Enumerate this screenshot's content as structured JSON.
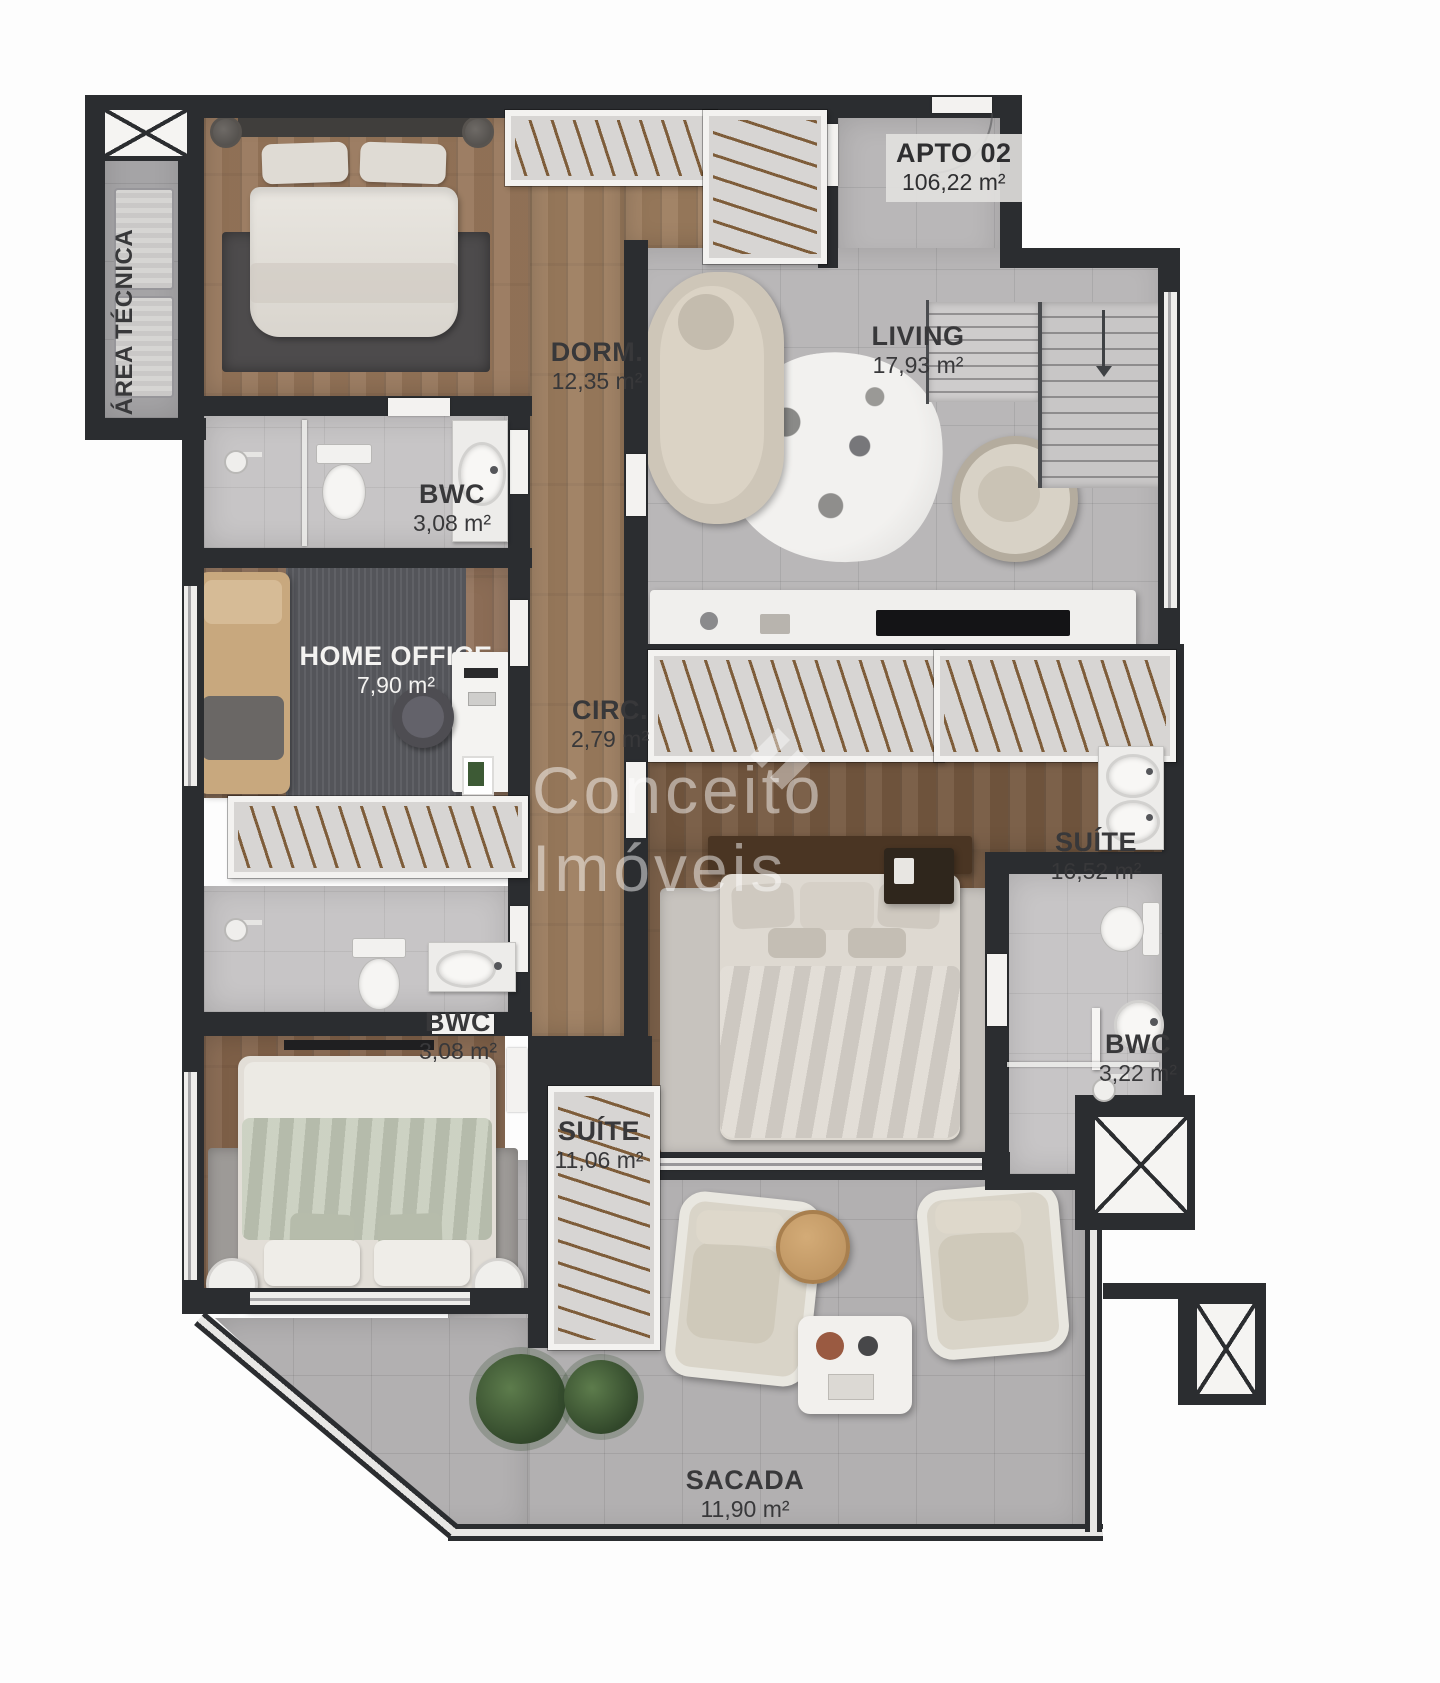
{
  "plan": {
    "apto": {
      "label": "APTO 02",
      "area": "106,22 m²"
    },
    "watermark": {
      "line1": "Conceito",
      "line2": "Imóveis"
    },
    "rooms": [
      {
        "id": "area-tecnica",
        "label": "ÁREA TÉCNICA",
        "area": ""
      },
      {
        "id": "dorm",
        "label": "DORM.",
        "area": "12,35 m²"
      },
      {
        "id": "living",
        "label": "LIVING",
        "area": "17,93 m²"
      },
      {
        "id": "bwc-top",
        "label": "BWC",
        "area": "3,08 m²"
      },
      {
        "id": "home-office",
        "label": "HOME OFFICE",
        "area": "7,90 m²"
      },
      {
        "id": "circulation",
        "label": "CIRC.",
        "area": "2,79 m²"
      },
      {
        "id": "suite-master",
        "label": "SUÍTE",
        "area": "16,52 m²"
      },
      {
        "id": "bwc-middle",
        "label": "BWC",
        "area": "3,08 m²"
      },
      {
        "id": "suite-second",
        "label": "SUÍTE",
        "area": "11,06 m²"
      },
      {
        "id": "bwc-suite",
        "label": "BWC",
        "area": "3,22 m²"
      },
      {
        "id": "sacada",
        "label": "SACADA",
        "area": "11,90 m²"
      }
    ],
    "colors": {
      "wall": "#2b2d30",
      "wood_light": "#97765a",
      "wood_dark": "#74573f",
      "tile": "#b9b7b8",
      "bath_tile": "#c7c5c6",
      "balcony_tile": "#b2b0b1",
      "label_text": "#38383a",
      "watermark": "#ffffff"
    }
  }
}
